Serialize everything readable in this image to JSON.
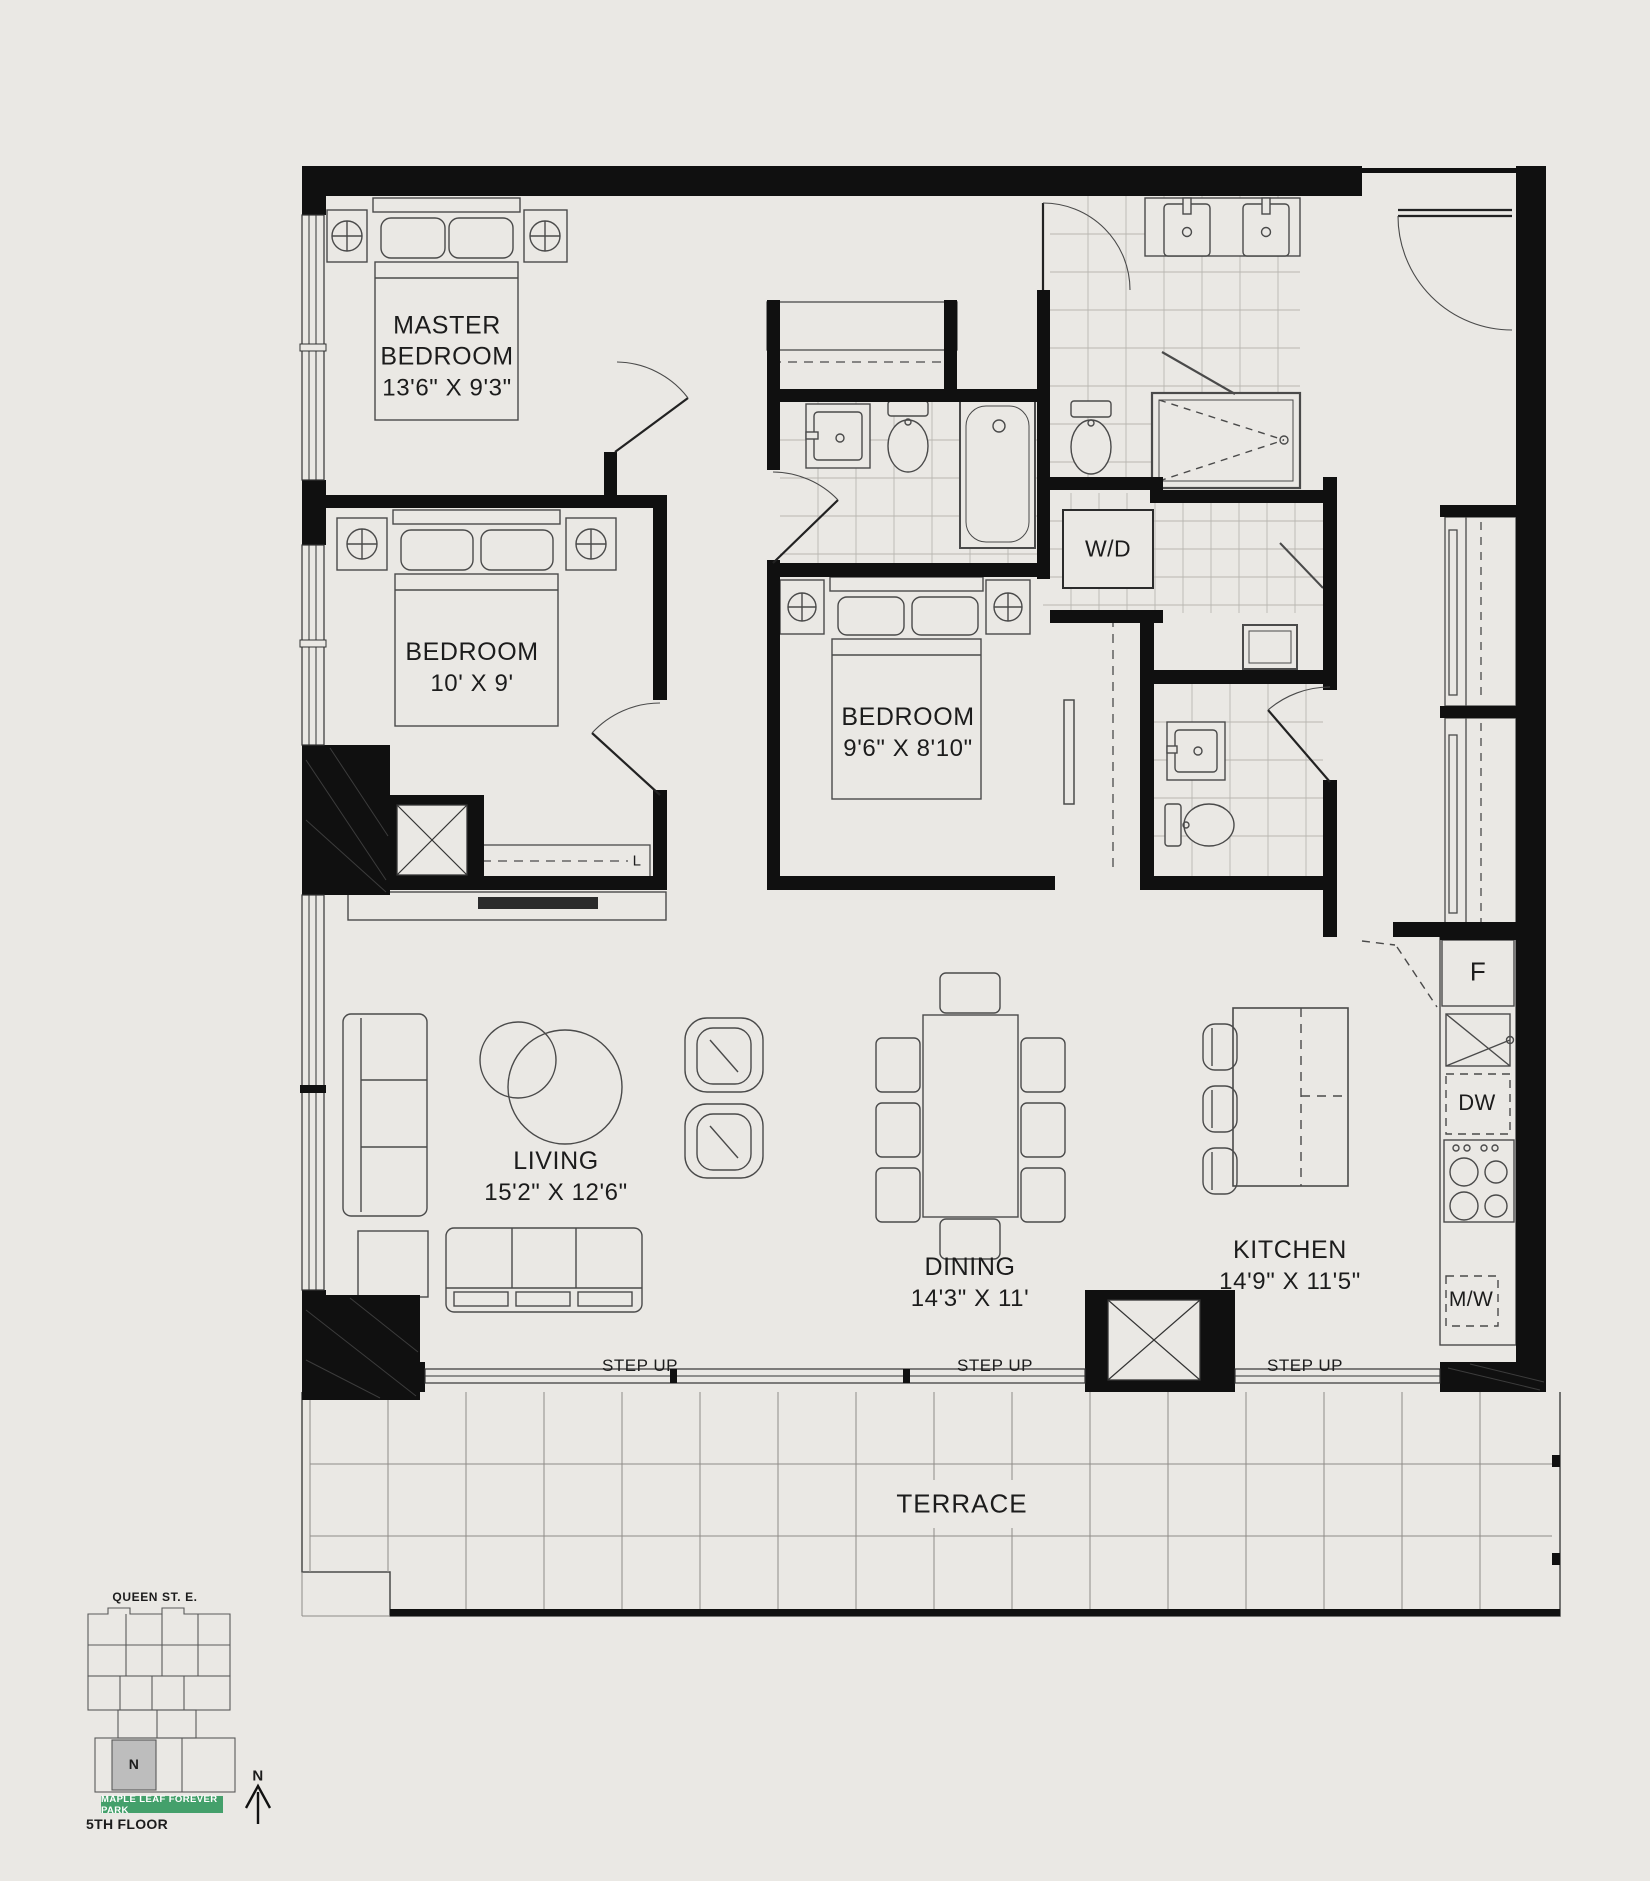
{
  "page": {
    "background": "#eae8e4",
    "wall_color": "#101010",
    "park_green": "#44a06b",
    "keyplan_unit_gray": "#bdbdbd"
  },
  "rooms": [
    {
      "id": "master-bedroom",
      "name": "MASTER BEDROOM",
      "dims": "13'6\" X 9'3\""
    },
    {
      "id": "bedroom-2",
      "name": "BEDROOM",
      "dims": "10' X 9'"
    },
    {
      "id": "bedroom-3",
      "name": "BEDROOM",
      "dims": "9'6\" X 8'10\""
    },
    {
      "id": "living",
      "name": "LIVING",
      "dims": "15'2\" X 12'6\""
    },
    {
      "id": "dining",
      "name": "DINING",
      "dims": "14'3\" X 11'"
    },
    {
      "id": "kitchen",
      "name": "KITCHEN",
      "dims": "14'9\" X 11'5\""
    },
    {
      "id": "terrace",
      "name": "TERRACE",
      "dims": ""
    }
  ],
  "appliances": {
    "washer_dryer": "W/D",
    "fridge": "F",
    "dishwasher": "DW",
    "microwave": "M/W"
  },
  "closets": {
    "linen": "L"
  },
  "annotations": {
    "step_up": "STEP UP"
  },
  "keyplan": {
    "street": "QUEEN ST. E.",
    "unit_label": "N",
    "park_banner": "MAPLE LEAF FOREVER PARK",
    "floor_label": "5TH FLOOR",
    "north_label": "N"
  }
}
